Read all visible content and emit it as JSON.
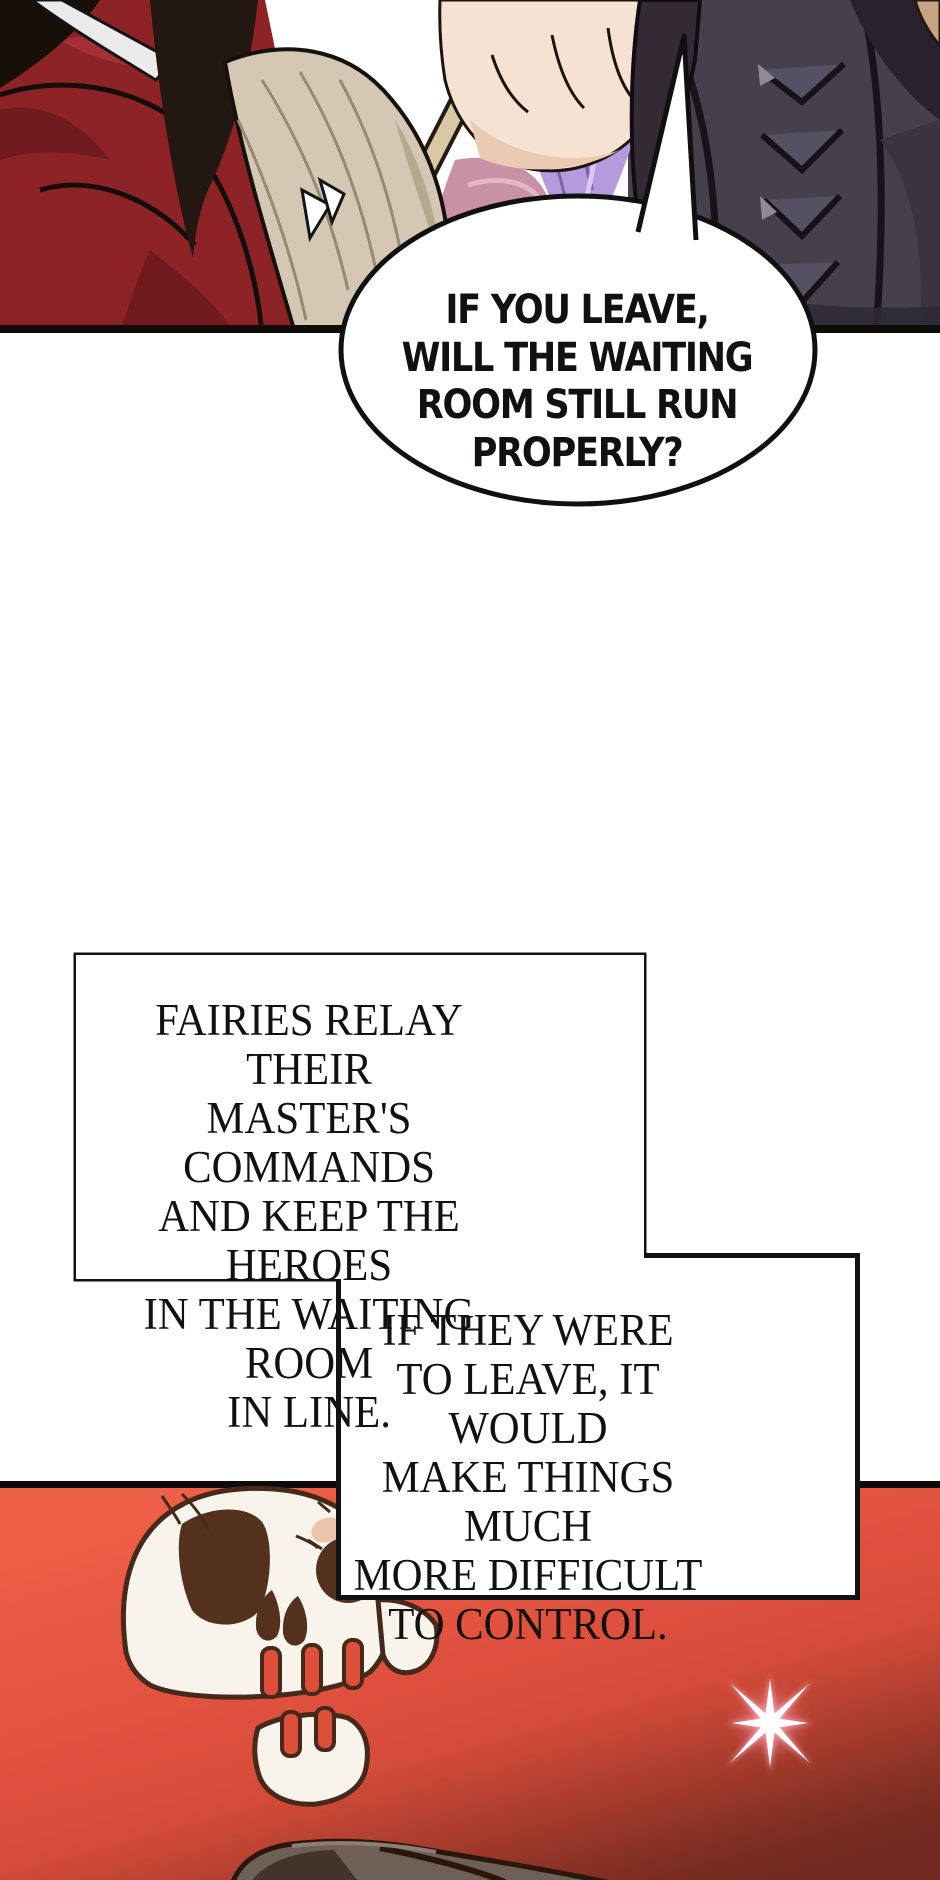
{
  "comic": {
    "speech_bubble": {
      "text": "IF YOU LEAVE,\nWILL THE WAITING\nROOM STILL RUN\nPROPERLY?"
    },
    "caption_box_1": {
      "text": "FAIRIES RELAY THEIR\nMASTER'S COMMANDS\nAND KEEP THE HEROES\nIN THE WAITING ROOM\nIN LINE."
    },
    "caption_box_2": {
      "text": "IF THEY WERE\nTO LEAVE, IT WOULD\nMAKE THINGS MUCH\nMORE DIFFICULT\nTO CONTROL."
    }
  },
  "icons": {
    "sparkle": "star-sparkle-icon"
  },
  "colors": {
    "ink": "#111111",
    "panel_red_bright": "#ef6048",
    "panel_red_mid": "#dd4f3b",
    "panel_red_shadow": "#732a1e",
    "skull_bone": "#f8f4ec",
    "skull_outline": "#46291a",
    "skull_socket": "#53311d",
    "sparkle_pink": "#ff9db7",
    "fabric_red": "#8d2327",
    "fabric_purple": "#b69ade",
    "fabric_mauve": "#c992a4",
    "armor_gray": "#45404b",
    "cuff_tan": "#d4c8b4",
    "skin": "#f6e2d2"
  }
}
